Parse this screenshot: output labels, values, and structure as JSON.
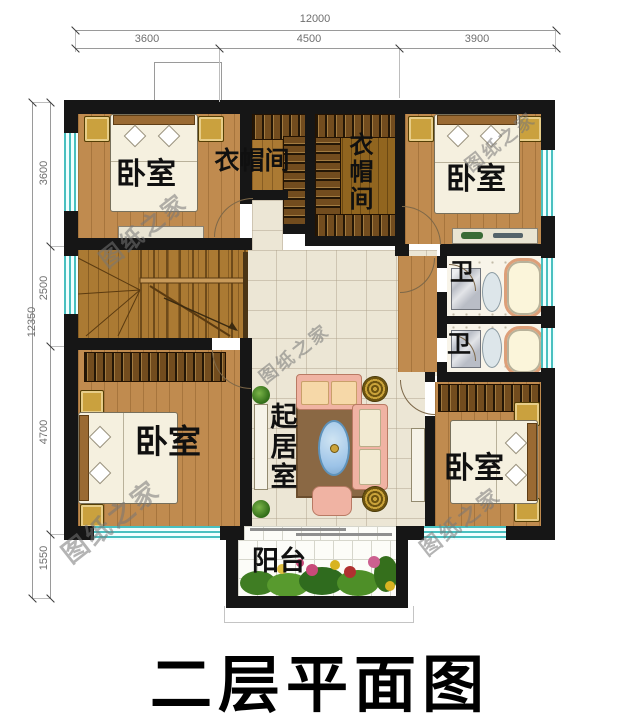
{
  "title": "二层平面图",
  "watermark_text": "图纸之家",
  "dimensions": {
    "top": {
      "total": "12000",
      "segments": [
        "3600",
        "4500",
        "3900"
      ]
    },
    "left": {
      "total": "12350",
      "segments": [
        "3600",
        "2500",
        "4700",
        "1550"
      ]
    }
  },
  "rooms": {
    "bedroom_top_left": {
      "label": "卧室"
    },
    "cloakroom_left": {
      "label": "衣帽间"
    },
    "cloakroom_right": {
      "label": "衣帽间"
    },
    "bedroom_top_right": {
      "label": "卧室"
    },
    "bath_upper": {
      "label": "卫"
    },
    "bath_lower": {
      "label": "卫"
    },
    "bedroom_bottom_left": {
      "label": "卧室"
    },
    "living_room": {
      "label": "起居室"
    },
    "bedroom_bottom_right": {
      "label": "卧室"
    },
    "balcony": {
      "label": "阳台"
    }
  },
  "colors": {
    "wall": "#161616",
    "wood_floor": "#c08b4f",
    "closet_wood": "#91651f",
    "hall_tile": "#ece6d5",
    "window_teal": "#49c0c0",
    "sofa_pink": "#f0b3a3",
    "rug_brown": "#8a6844",
    "dim_grey": "#6f6f6f",
    "watermark_grey": "#767676"
  }
}
